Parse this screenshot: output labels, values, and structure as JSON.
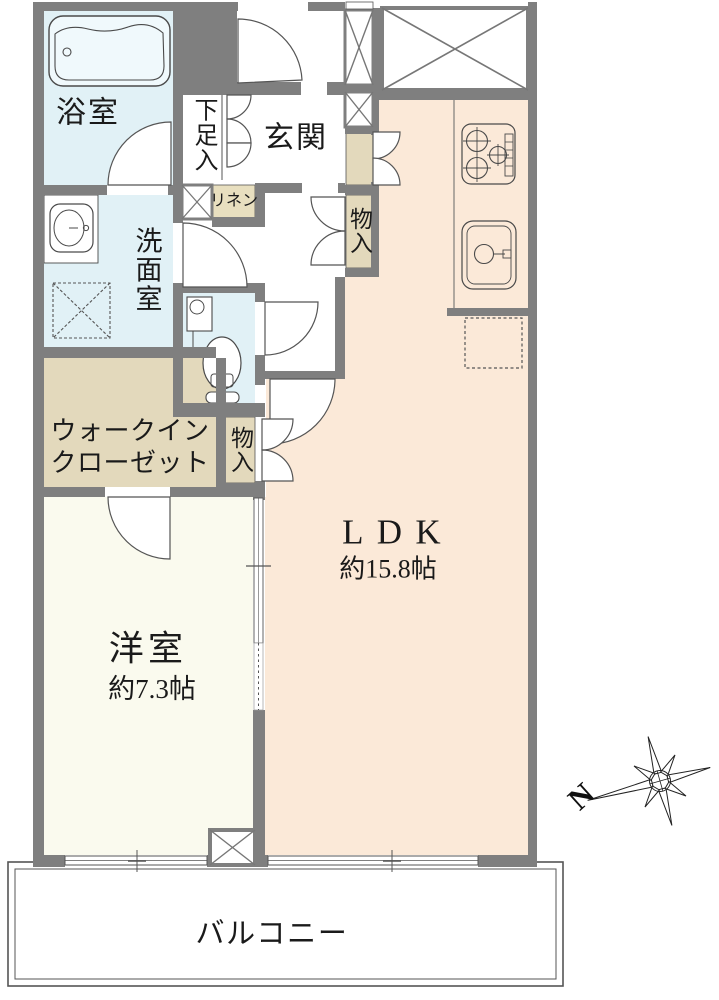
{
  "plan_type": "floor-plan",
  "rooms": {
    "bath": {
      "label": "浴室"
    },
    "shoe_storage": {
      "label": "下足入"
    },
    "entrance": {
      "label": "玄関"
    },
    "linen": {
      "label": "リネン"
    },
    "washroom": {
      "label": "洗面室"
    },
    "hall_storage": {
      "label": "物入"
    },
    "lower_storage": {
      "label": "物入"
    },
    "walk_in_closet": {
      "line1": "ウォークイン",
      "line2": "クローゼット"
    },
    "ldk": {
      "label": "LDK",
      "area": "約15.8帖"
    },
    "bedroom": {
      "label": "洋室",
      "area": "約7.3帖"
    },
    "balcony": {
      "label": "バルコニー"
    }
  },
  "compass": {
    "north_label": "N"
  },
  "fixtures": [
    "bathtub-icon",
    "washbasin-icon",
    "washing-machine-space-icon",
    "toilet-icon",
    "gas-stove-icon",
    "kitchen-sink-icon",
    "refrigerator-space-icon"
  ],
  "colors": {
    "wall": "#7f7f7f",
    "water": "#e1f1f6",
    "ldk": "#fbe9d8",
    "bedroom": "#fafaee",
    "closet": "#e3d9bc",
    "linen": "#e8dfbf",
    "line": "#555555",
    "text": "#1a1a1a"
  }
}
